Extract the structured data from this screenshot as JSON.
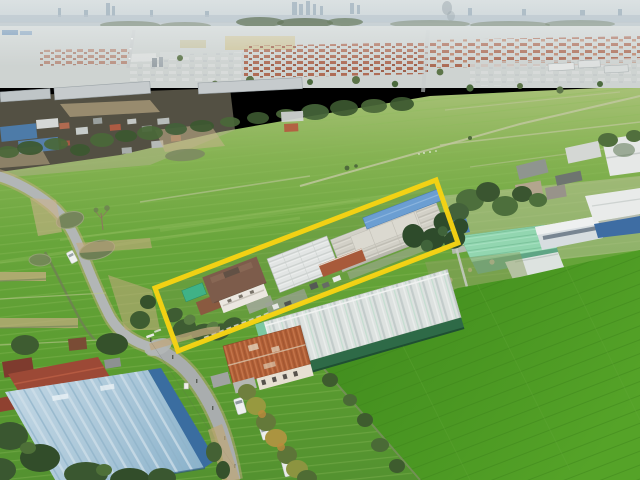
{
  "image": {
    "kind": "aerial-drone-photograph",
    "width": 640,
    "height": 480,
    "description": "Aerial drone photo of a long, narrow land plot outlined in yellow containing a two-storey brown-roofed house and white-roofed warehouses. Around it: bright green rice paddies, a curving rural road with ponds, a front road with white vehicles, a rust-orange corrugated roof building, a white-roofed factory with dark green walls, a mint-green roofed factory, a light-blue roofed warehouse, suburban housing estates with red roofs, and a hazy city skyline on the horizon."
  },
  "annotation": {
    "name": "land-plot-boundary",
    "shape": "quadrilateral",
    "color": "#F6D313",
    "stroke_width": "5",
    "points_str": "155,288 436,180 458,243 178,351"
  },
  "landmarks": [
    {
      "id": "city-skyline",
      "label": "hazy city skyline with distant towers"
    },
    {
      "id": "housing-estates",
      "label": "suburban housing estates with red-brown roofs"
    },
    {
      "id": "rice-field-main",
      "label": "large green rice paddies with levee paths"
    },
    {
      "id": "rural-road-left",
      "label": "curving rural road with white car"
    },
    {
      "id": "roadside-ponds",
      "label": "murky roadside ponds"
    },
    {
      "id": "highlighted-property",
      "label": "yellow-outlined plot with house, garden and warehouses"
    },
    {
      "id": "house",
      "label": "two-storey house with brown hip roof and roof deck"
    },
    {
      "id": "warehouses",
      "label": "white corrugated warehouse roofs inside plot"
    },
    {
      "id": "teal-warehouse",
      "label": "factory with white roof and dark green wall"
    },
    {
      "id": "orange-roof-building",
      "label": "rust-orange corrugated roof building"
    },
    {
      "id": "mint-roof-warehouse",
      "label": "mint-green roofed factory"
    },
    {
      "id": "blue-roof-warehouse",
      "label": "large light-blue roofed warehouse"
    },
    {
      "id": "rice-field-bottom-right",
      "label": "bright green paddy field"
    },
    {
      "id": "main-road-bottom",
      "label": "front road with white van, car and truck"
    },
    {
      "id": "trees",
      "label": "tree lines and roadside trees with yellow-green foliage"
    }
  ],
  "palette": {
    "boundary_yellow": "#F6D313",
    "field_green": "#5D9C31",
    "bright_field_green": "#4A9423",
    "haze_grey": "#CBD5D9",
    "road_grey": "#AFB3B3",
    "estate_red": "#AD6850",
    "house_brown": "#7D5C4B",
    "warehouse_white": "#E2E5E4",
    "teal_wall_green": "#2E6A47",
    "mint_roof": "#92D6B0",
    "orange_roof": "#B05F36",
    "blue_roof": "#A9C6D8",
    "dirt_tan": "#C5AC82",
    "pond_olive": "#75855B"
  }
}
